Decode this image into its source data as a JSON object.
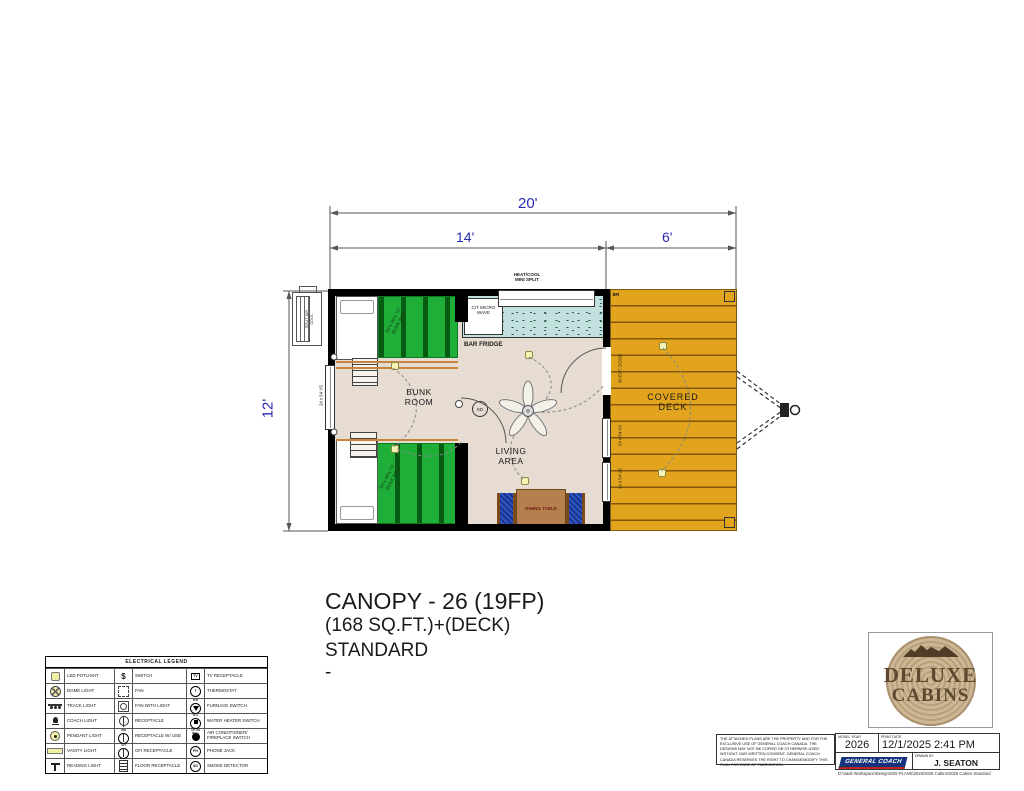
{
  "colors": {
    "dim_blue": "#2a2ab0",
    "deck_orange": "#e2a41c",
    "bunk_green": "#1fae38",
    "floor_tan": "#e7dcd2",
    "counter_teal": "#c2e0dd",
    "table_brown": "#b5804d",
    "chair_blue": "#2d56c8",
    "wall": "#000000",
    "logo_brown": "#5c4930",
    "brand_blue": "#14337c",
    "brand_red": "#c12222"
  },
  "dims": {
    "total": "20'",
    "cabin": "14'",
    "deck": "6'",
    "side": "12'"
  },
  "plan": {
    "heat_cool_1": "HEAT/COOL",
    "heat_cool_2": "MINI SPLIT",
    "micro": "C/T MICRO WAVE",
    "bar_fridge": "BAR FRIDGE",
    "bunk_room": "BUNK ROOM",
    "living_area": "LIVING AREA",
    "dining_table": "DINING TABLE",
    "covered_deck": "COVERED DECK",
    "split_air": "SPLIT AIR COOL",
    "ext_door": "36 EXT. DOOR",
    "window": "24 x 54 VS",
    "bunk_size": "50\"x 48\"x 74\"",
    "bunk_bed": "BUNK BED",
    "sd": "SD",
    "br": "BR"
  },
  "title": {
    "line1": "CANOPY - 26 (19FP)",
    "line2": "(168 SQ.FT.)+(DECK)",
    "line3": "STANDARD",
    "line4": "-"
  },
  "legend": {
    "title": "ELECTRICAL LEGEND",
    "items": [
      {
        "label": "LED POTLIGHT",
        "glyph": ""
      },
      {
        "label": "SWITCH",
        "glyph": "$"
      },
      {
        "label": "TV RECEPTACLE",
        "glyph": "TV"
      },
      {
        "label": "DOME LIGHT",
        "glyph": ""
      },
      {
        "label": "FAN",
        "glyph": ""
      },
      {
        "label": "THERMOSTAT",
        "glyph": "T"
      },
      {
        "label": "TRACK LIGHT",
        "glyph": ""
      },
      {
        "label": "FAN WITH LIGHT",
        "glyph": ""
      },
      {
        "label": "FURNACE SWITCH",
        "glyph": "FUR"
      },
      {
        "label": "COACH LIGHT",
        "glyph": ""
      },
      {
        "label": "RECEPTACLE",
        "glyph": ""
      },
      {
        "label": "WATER HEATER SWITCH",
        "glyph": "W.H."
      },
      {
        "label": "PENDANT LIGHT",
        "glyph": ""
      },
      {
        "label": "RECEPTACLE W/ USB",
        "glyph": "USB"
      },
      {
        "label": "AIR CONDITIONER/ FIREPLACE SWITCH",
        "glyph": "A/C ON WALL"
      },
      {
        "label": "VANITY LIGHT",
        "glyph": ""
      },
      {
        "label": "GFI RECEPTACLE",
        "glyph": "GFI"
      },
      {
        "label": "PHONE JACK",
        "glyph": "PH"
      },
      {
        "label": "READING LIGHT",
        "glyph": ""
      },
      {
        "label": "FLOOR RECEPTACLE",
        "glyph": ""
      },
      {
        "label": "SMOKE DETECTOR",
        "glyph": "SD"
      }
    ]
  },
  "logo": {
    "line1": "DELUXE",
    "line2": "CABINS"
  },
  "titleblock": {
    "disclaimer": "THE ATTACHED PLANS ARE THE PROPERTY AND FOR THE EXCLUSIVE USE OF GENERAL COACH CANADA. THE DESIGNS MAY NOT BE COPIED OR OTHERWISE USED WITHOUT OUR WRITTEN CONSENT. GENERAL COACH CANADA RESERVES THE RIGHT TO CHANGE/MODIFY THIS PLAN FOR EASE OF FABRICATION.",
    "model_year_label": "MODEL YEAR",
    "model_year": "2026",
    "print_date_label": "PRINT DATE",
    "print_date": "12/1/2025 2:41 PM",
    "drawn_by_label": "DRAWN BY",
    "drawn_by": "J. SEATON",
    "brand": "GENERAL COACH",
    "brand_sub": "CABINS",
    "file_path": "D:\\Vault Workspace\\Designs\\2D-PLANS\\2026\\2026 Cabins\\2026 Cabins Standard"
  }
}
